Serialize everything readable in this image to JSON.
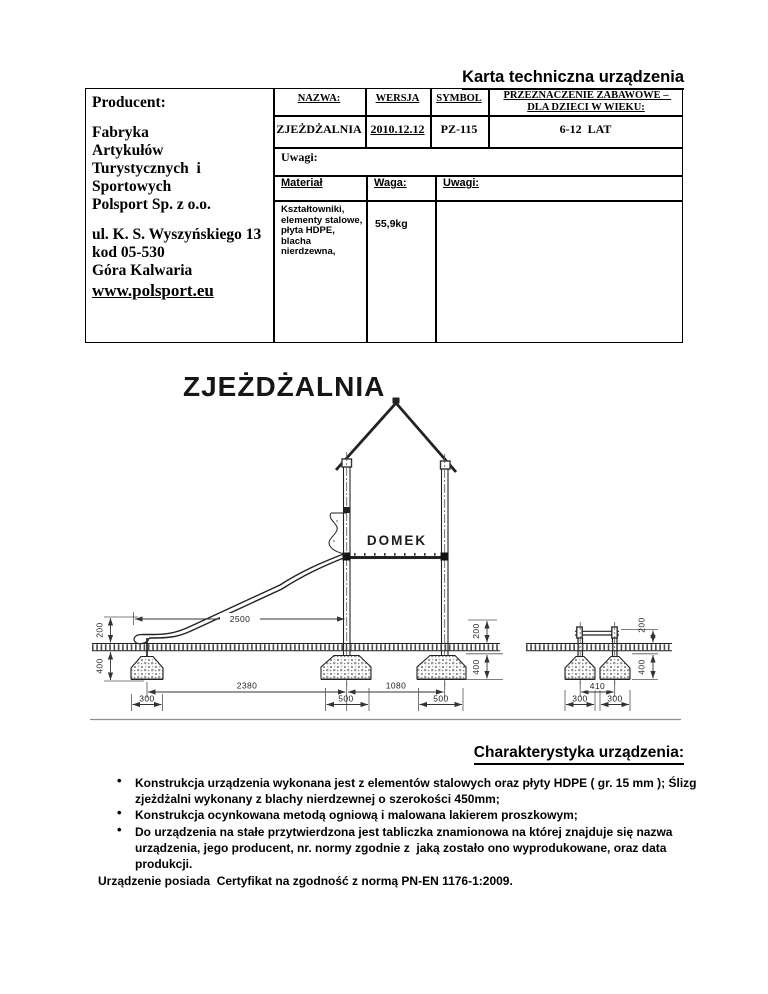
{
  "page_title": "Karta techniczna urządzenia",
  "producer": {
    "label": "Producent:",
    "name_lines": [
      "Fabryka",
      "Artykułów",
      "Turystycznych  i",
      "Sportowych",
      "Polsport Sp. z o.o."
    ],
    "address_lines": [
      "ul. K. S. Wyszyńskiego 13",
      "kod 05-530",
      "Góra Kalwaria"
    ],
    "website": "www.polsport.eu"
  },
  "spec_table": {
    "headers": {
      "name": "NAZWA:",
      "version": "WERSJA",
      "symbol": "SYMBOL",
      "purpose": "PRZEZNACZENIE ZABAWOWE – DLA DZIECI W WIEKU:"
    },
    "values": {
      "name": "ZJEŻDŻALNIA",
      "version": "2010.12.12",
      "symbol": "PZ-115",
      "purpose": "6-12  LAT"
    },
    "remarks_label": "Uwagi:",
    "material_section": {
      "material_label": "Materiał",
      "weight_label": "Waga:",
      "remarks_label": "Uwagi:",
      "material_value": "Kształtowniki, elementy stalowe, płyta HDPE, blacha nierdzewna,",
      "weight_value": "55,9kg"
    }
  },
  "drawing": {
    "title": "ZJEŻDŻALNIA",
    "house_label": "DOMEK",
    "dims": {
      "slide_length": "2500",
      "left_height": "200",
      "left_footing_depth": "400",
      "span_slide_to_house": "2380",
      "span_house_posts": "1080",
      "footing_w_slide": "300",
      "footing_w_post1": "500",
      "footing_w_post2": "500",
      "right_height": "200",
      "right_footing_depth": "400",
      "side_post_spacing": "410",
      "side_footing_w1": "300",
      "side_footing_w2": "300"
    }
  },
  "characteristics": {
    "title": "Charakterystyka urządzenia:",
    "bullets": [
      "Konstrukcja urządzenia wykonana jest z elementów stalowych oraz płyty HDPE ( gr. 15 mm ); Ślizg zjeżdżalni wykonany z blachy nierdzewnej o szerokości 450mm;",
      "Konstrukcja ocynkowana metodą ogniową i malowana lakierem proszkowym;",
      "Do urządzenia na stałe przytwierdzona jest tabliczka znamionowa na której znajduje się nazwa urządzenia, jego producent, nr. normy zgodnie z  jaką zostało ono wyprodukowane, oraz data produkcji."
    ],
    "footer": "Urządzenie posiada  Certyfikat na zgodność z normą PN-EN 1176-1:2009."
  }
}
